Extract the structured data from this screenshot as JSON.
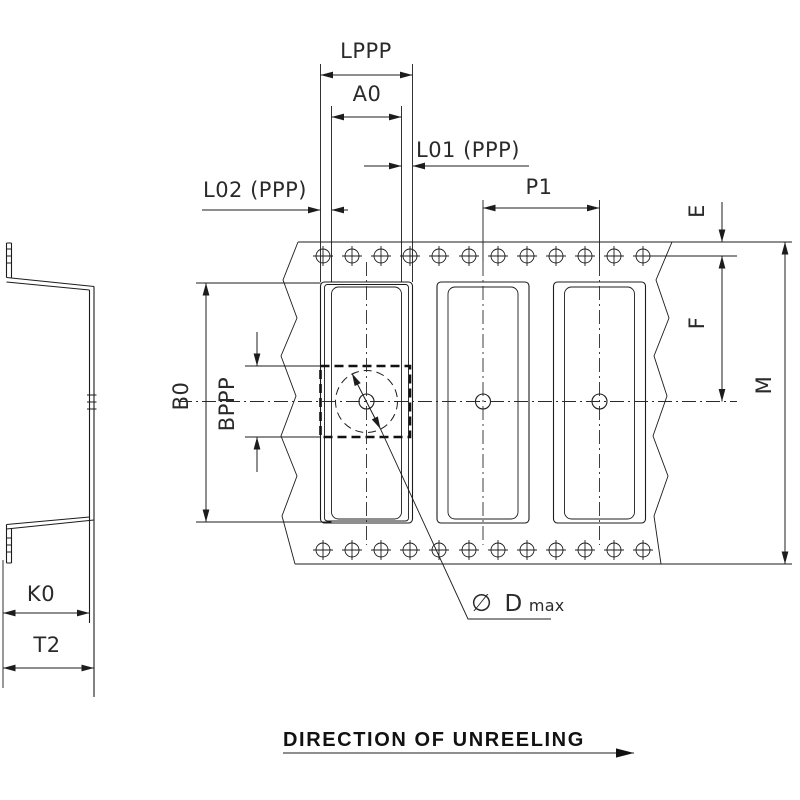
{
  "drawing": {
    "type": "tape-and-reel carrier tape packaging specification, technical line drawing",
    "ink_color": "#1c1c1c",
    "background_color": "#ffffff",
    "views": {
      "side_view": "tape pocket cross-section profile (left side)",
      "top_view": "carrier tape strip with sprocket holes and 3 component pockets, broken ends (zigzag)"
    },
    "structure": {
      "sprocket_holes_per_row": 12,
      "sprocket_hole_rows": 2,
      "pockets_visible": 3
    }
  },
  "dimensions": {
    "lppp": "LPPP",
    "a0": "A0",
    "l01": "L01 (PPP)",
    "l02": "L02 (PPP)",
    "p1": "P1",
    "e": "E",
    "f": "F",
    "m": "M",
    "b0": "B0",
    "bppp": "BPPP",
    "k0": "K0",
    "t2": "T2",
    "dmax": {
      "symbol": "∅",
      "letter": "D",
      "subscript": "max"
    }
  },
  "footer": {
    "direction_label": "DIRECTION OF UNREELING"
  }
}
